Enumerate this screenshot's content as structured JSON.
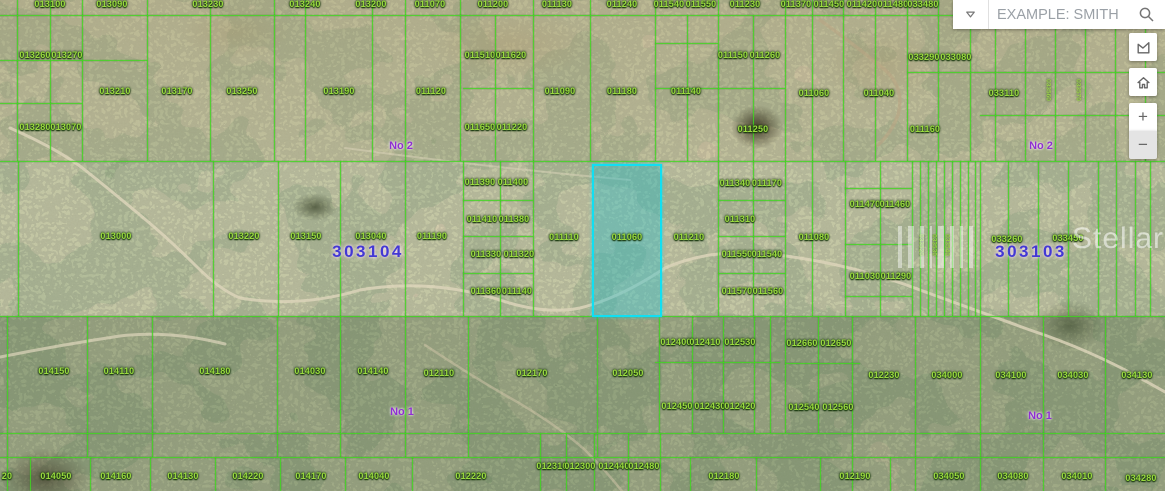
{
  "map": {
    "grid_color": "#3fd61f",
    "label_color": "#9ada3f",
    "section_number_color": "#4338d4",
    "block_number_color": "#8f2ed2",
    "highlight_border_color": "#11dff2",
    "highlighted_parcel_id": "011060",
    "watermark_text": "StellarMLS",
    "section_labels": [
      [
        "303104",
        368,
        252
      ],
      [
        "303103",
        1031,
        252
      ]
    ],
    "block_labels": [
      [
        "No 2",
        401,
        146
      ],
      [
        "No 2",
        1041,
        146
      ],
      [
        "No 1",
        402,
        412
      ],
      [
        "No 1",
        1040,
        416
      ]
    ],
    "parcel_labels": [
      [
        "013100",
        50,
        4
      ],
      [
        "013090",
        112,
        4
      ],
      [
        "013230",
        208,
        4
      ],
      [
        "013240",
        305,
        4
      ],
      [
        "013200",
        371,
        4
      ],
      [
        "011070",
        430,
        4
      ],
      [
        "011200",
        493,
        4
      ],
      [
        "011130",
        557,
        4
      ],
      [
        "011240",
        622,
        4
      ],
      [
        "011540",
        669,
        4
      ],
      [
        "011550",
        701,
        4
      ],
      [
        "011230",
        745,
        4
      ],
      [
        "011370",
        796,
        4
      ],
      [
        "011450",
        829,
        4
      ],
      [
        "011420",
        862,
        4
      ],
      [
        "011480",
        893,
        4
      ],
      [
        "033480",
        923,
        4
      ],
      [
        "013260",
        35,
        55
      ],
      [
        "013270",
        67,
        55
      ],
      [
        "011510",
        480,
        55
      ],
      [
        "011620",
        511,
        55
      ],
      [
        "011150",
        733,
        55
      ],
      [
        "011260",
        765,
        55
      ],
      [
        "033290",
        924,
        57
      ],
      [
        "033080",
        956,
        57
      ],
      [
        "013210",
        115,
        91
      ],
      [
        "013170",
        177,
        91
      ],
      [
        "013250",
        242,
        91
      ],
      [
        "013190",
        339,
        91
      ],
      [
        "011120",
        431,
        91
      ],
      [
        "011090",
        560,
        91
      ],
      [
        "011180",
        622,
        91
      ],
      [
        "011140",
        686,
        91
      ],
      [
        "011060",
        814,
        93
      ],
      [
        "011040",
        879,
        93
      ],
      [
        "033110",
        1004,
        93
      ],
      [
        "013280",
        35,
        127
      ],
      [
        "013070",
        66,
        127
      ],
      [
        "011650",
        480,
        127
      ],
      [
        "011220",
        512,
        127
      ],
      [
        "011250",
        753,
        129
      ],
      [
        "011160",
        925,
        129
      ],
      [
        "011390",
        480,
        182
      ],
      [
        "011400",
        513,
        182
      ],
      [
        "011340",
        735,
        183
      ],
      [
        "011170",
        767,
        183
      ],
      [
        "011470",
        865,
        204
      ],
      [
        "011460",
        895,
        204
      ],
      [
        "011410",
        482,
        219
      ],
      [
        "011380",
        514,
        219
      ],
      [
        "011310",
        740,
        219
      ],
      [
        "013000",
        116,
        236
      ],
      [
        "013220",
        244,
        236
      ],
      [
        "013150",
        306,
        236
      ],
      [
        "013040",
        371,
        236
      ],
      [
        "011190",
        432,
        236
      ],
      [
        "011110",
        564,
        237
      ],
      [
        "011060",
        627,
        237
      ],
      [
        "011210",
        689,
        237
      ],
      [
        "011080",
        814,
        237
      ],
      [
        "033260",
        1007,
        239
      ],
      [
        "033450",
        1068,
        238
      ],
      [
        "011330",
        486,
        254
      ],
      [
        "011320",
        519,
        254
      ],
      [
        "011550",
        737,
        254
      ],
      [
        "011540",
        767,
        254
      ],
      [
        "011030",
        865,
        276
      ],
      [
        "011290",
        896,
        276
      ],
      [
        "011360",
        486,
        291
      ],
      [
        "011140",
        517,
        291
      ],
      [
        "011570",
        737,
        291
      ],
      [
        "011560",
        768,
        291
      ],
      [
        "012400",
        676,
        342
      ],
      [
        "012410",
        705,
        342
      ],
      [
        "012530",
        740,
        342
      ],
      [
        "012660",
        802,
        343
      ],
      [
        "012650",
        836,
        343
      ],
      [
        "014150",
        54,
        371
      ],
      [
        "014110",
        119,
        371
      ],
      [
        "014180",
        215,
        371
      ],
      [
        "014030",
        310,
        371
      ],
      [
        "014140",
        373,
        371
      ],
      [
        "012110",
        439,
        373
      ],
      [
        "012170",
        532,
        373
      ],
      [
        "012050",
        628,
        373
      ],
      [
        "012230",
        884,
        375
      ],
      [
        "034000",
        947,
        375
      ],
      [
        "034100",
        1011,
        375
      ],
      [
        "034030",
        1073,
        375
      ],
      [
        "034130",
        1137,
        375
      ],
      [
        "012450",
        677,
        406
      ],
      [
        "012430",
        710,
        406
      ],
      [
        "012420",
        740,
        406
      ],
      [
        "012540",
        804,
        407
      ],
      [
        "012560",
        838,
        407
      ],
      [
        "012310",
        552,
        466
      ],
      [
        "012300",
        580,
        466
      ],
      [
        "012440",
        614,
        466
      ],
      [
        "012480",
        644,
        466
      ],
      [
        "20",
        7,
        476
      ],
      [
        "014050",
        56,
        476
      ],
      [
        "014160",
        116,
        476
      ],
      [
        "014130",
        183,
        476
      ],
      [
        "014220",
        248,
        476
      ],
      [
        "014170",
        311,
        476
      ],
      [
        "014040",
        374,
        476
      ],
      [
        "012220",
        471,
        476
      ],
      [
        "012180",
        724,
        476
      ],
      [
        "012190",
        855,
        476
      ],
      [
        "034050",
        949,
        476
      ],
      [
        "034080",
        1013,
        476
      ],
      [
        "034010",
        1077,
        476
      ],
      [
        "034280",
        1141,
        478
      ]
    ],
    "rotated_labels": [
      [
        "033520",
        921,
        245
      ],
      [
        "033530",
        934,
        245
      ],
      [
        "033540",
        947,
        245
      ],
      [
        "033560",
        1048,
        90
      ],
      [
        "033570",
        1078,
        90
      ]
    ]
  },
  "search": {
    "placeholder": "EXAMPLE: SMITH JER...",
    "dropdown_icon": "chevron-down",
    "search_icon": "magnifier"
  },
  "controls": {
    "draw_polygon_icon": "draw-polygon",
    "home_icon": "home",
    "zoom_in_label": "+",
    "zoom_out_label": "−"
  }
}
